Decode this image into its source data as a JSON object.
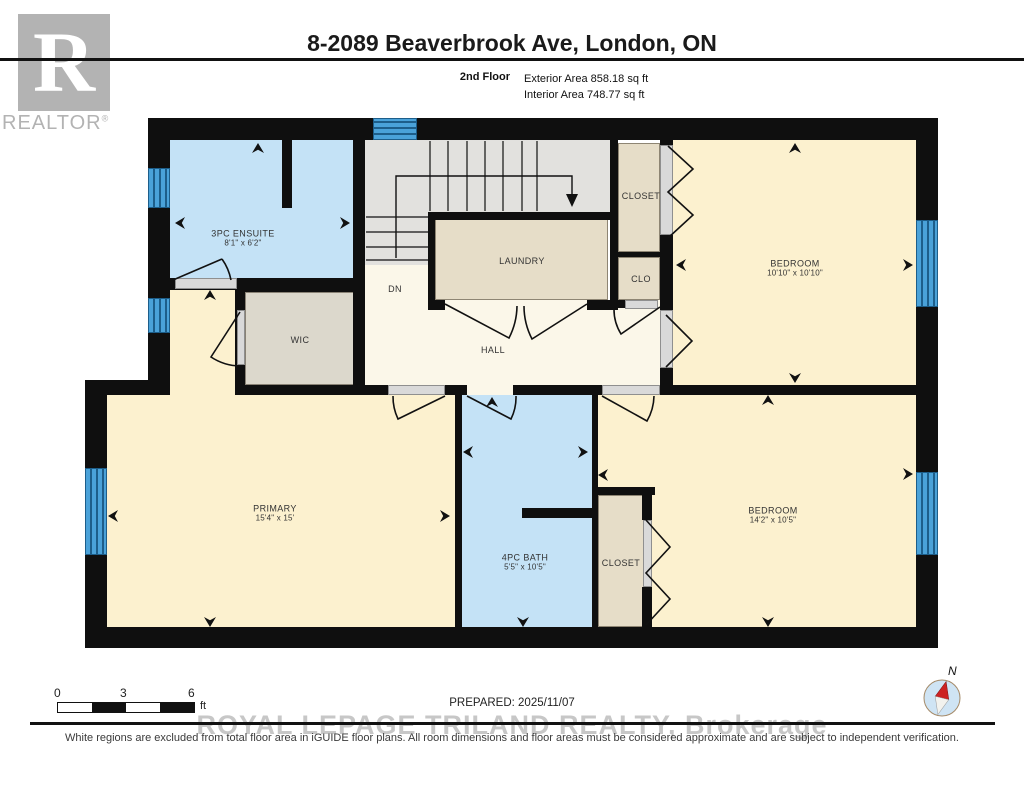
{
  "header": {
    "title": "8-2089 Beaverbrook Ave, London, ON",
    "floor_label": "2nd Floor",
    "exterior_area": "Exterior Area 858.18 sq ft",
    "interior_area": "Interior Area 748.77 sq ft",
    "logo_letter": "R",
    "logo_text": "REALTOR",
    "logo_reg": "®"
  },
  "footer": {
    "scale_ticks": [
      "0",
      "3",
      "6"
    ],
    "scale_unit": "ft",
    "prepared": "PREPARED: 2025/11/07",
    "watermark": "ROYAL LEPAGE TRILAND REALTY, Brokerage",
    "disclaimer": "White regions are excluded from total floor area in iGUIDE floor plans. All room dimensions and floor areas must be considered approximate and are subject to independent verification.",
    "compass_label": "N"
  },
  "colors": {
    "wall": "#0f0f0f",
    "blue_room": "#c4e2f6",
    "cream": "#fcf1cf",
    "hall_cream": "#fbf7e9",
    "tan": "#e6ddc8",
    "wic_tan": "#dcd8cc",
    "stair_gray": "#e2e1de",
    "window_blue": "#4aa2d9",
    "window_line": "#1d5e8a",
    "threshold": "#d9d9d9",
    "threshold_border": "#8f8f8f",
    "line": "#111111"
  },
  "plan": {
    "rooms": [
      {
        "id": "ensuite",
        "label": "3PC ENSUITE",
        "dims": "8'1\" x 6'2\"",
        "x": 90,
        "y": 30,
        "w": 183,
        "h": 140,
        "fill": "blue_room",
        "lx": 163,
        "ly": 128,
        "outline": false
      },
      {
        "id": "stairs-upper",
        "label": "",
        "dims": "",
        "x": 285,
        "y": 30,
        "w": 245,
        "h": 72,
        "fill": "stair_gray",
        "lx": 0,
        "ly": 0,
        "outline": false
      },
      {
        "id": "stairs-lower",
        "label": "",
        "dims": "",
        "x": 285,
        "y": 102,
        "w": 63,
        "h": 53,
        "fill": "stair_gray",
        "lx": 0,
        "ly": 0,
        "outline": false
      },
      {
        "id": "dn-area",
        "label": "DN",
        "dims": "",
        "x": 285,
        "y": 155,
        "w": 63,
        "h": 35,
        "fill": "hall_cream",
        "lx": 315,
        "ly": 179,
        "outline": false
      },
      {
        "id": "laundry",
        "label": "LAUNDRY",
        "dims": "",
        "x": 355,
        "y": 108,
        "w": 173,
        "h": 82,
        "fill": "tan",
        "lx": 442,
        "ly": 151,
        "outline": true
      },
      {
        "id": "closet-top",
        "label": "CLOSET",
        "dims": "",
        "x": 538,
        "y": 33,
        "w": 42,
        "h": 109,
        "fill": "tan",
        "lx": 561,
        "ly": 86,
        "outline": true
      },
      {
        "id": "clo",
        "label": "CLO",
        "dims": "",
        "x": 538,
        "y": 147,
        "w": 42,
        "h": 43,
        "fill": "tan",
        "lx": 561,
        "ly": 169,
        "outline": true
      },
      {
        "id": "bedroom-1",
        "label": "BEDROOM",
        "dims": "10'10\" x 10'10\"",
        "x": 593,
        "y": 30,
        "w": 243,
        "h": 245,
        "fill": "cream",
        "lx": 715,
        "ly": 158,
        "outline": false
      },
      {
        "id": "vestibule",
        "label": "",
        "dims": "",
        "x": 90,
        "y": 180,
        "w": 65,
        "h": 105,
        "fill": "cream",
        "lx": 0,
        "ly": 0,
        "outline": false
      },
      {
        "id": "wic",
        "label": "WIC",
        "dims": "",
        "x": 165,
        "y": 182,
        "w": 110,
        "h": 93,
        "fill": "wic_tan",
        "lx": 220,
        "ly": 230,
        "outline": true
      },
      {
        "id": "hall",
        "label": "HALL",
        "dims": "",
        "x": 285,
        "y": 190,
        "w": 308,
        "h": 95,
        "fill": "hall_cream",
        "lx": 413,
        "ly": 240,
        "outline": false
      },
      {
        "id": "primary",
        "label": "PRIMARY",
        "dims": "15'4\" x 15'",
        "x": 27,
        "y": 285,
        "w": 348,
        "h": 232,
        "fill": "cream",
        "lx": 195,
        "ly": 403,
        "outline": false
      },
      {
        "id": "bath",
        "label": "4PC BATH",
        "dims": "5'5\" x 10'5\"",
        "x": 382,
        "y": 285,
        "w": 130,
        "h": 242,
        "fill": "blue_room",
        "lx": 445,
        "ly": 452,
        "outline": false
      },
      {
        "id": "bedroom-2",
        "label": "BEDROOM",
        "dims": "14'2\" x 10'5\"",
        "x": 518,
        "y": 285,
        "w": 318,
        "h": 232,
        "fill": "cream",
        "lx": 693,
        "ly": 405,
        "outline": false
      },
      {
        "id": "closet-bottom",
        "label": "CLOSET",
        "dims": "",
        "x": 518,
        "y": 385,
        "w": 52,
        "h": 132,
        "fill": "tan",
        "lx": 541,
        "ly": 453,
        "outline": true
      }
    ],
    "walls": [
      [
        68,
        8,
        790,
        22
      ],
      [
        68,
        8,
        22,
        277
      ],
      [
        5,
        270,
        85,
        15
      ],
      [
        5,
        270,
        22,
        268
      ],
      [
        5,
        517,
        853,
        21
      ],
      [
        836,
        8,
        22,
        530
      ],
      [
        273,
        30,
        12,
        145
      ],
      [
        202,
        30,
        10,
        68
      ],
      [
        90,
        168,
        183,
        12
      ],
      [
        155,
        175,
        120,
        7
      ],
      [
        155,
        175,
        10,
        110
      ],
      [
        273,
        175,
        12,
        110
      ],
      [
        348,
        103,
        7,
        87
      ],
      [
        348,
        102,
        182,
        8
      ],
      [
        530,
        30,
        8,
        170
      ],
      [
        538,
        142,
        42,
        5
      ],
      [
        538,
        190,
        12,
        8
      ],
      [
        580,
        30,
        13,
        5
      ],
      [
        580,
        125,
        13,
        75
      ],
      [
        580,
        258,
        13,
        27
      ],
      [
        155,
        275,
        153,
        10
      ],
      [
        365,
        275,
        22,
        10
      ],
      [
        433,
        275,
        89,
        10
      ],
      [
        580,
        275,
        256,
        10
      ],
      [
        375,
        275,
        7,
        252
      ],
      [
        512,
        283,
        6,
        244
      ],
      [
        442,
        398,
        70,
        10
      ],
      [
        518,
        377,
        57,
        8
      ],
      [
        562,
        377,
        10,
        33
      ],
      [
        562,
        477,
        10,
        40
      ],
      [
        348,
        190,
        17,
        10
      ],
      [
        507,
        190,
        23,
        10
      ]
    ],
    "thresholds": [
      [
        95,
        168,
        62,
        11
      ],
      [
        157,
        200,
        8,
        55
      ],
      [
        308,
        275,
        57,
        10
      ],
      [
        522,
        275,
        58,
        10
      ],
      [
        580,
        35,
        13,
        90
      ],
      [
        580,
        200,
        13,
        58
      ],
      [
        563,
        410,
        9,
        67
      ],
      [
        545,
        190,
        33,
        9
      ]
    ],
    "windows": [
      [
        293,
        8,
        44,
        22
      ],
      [
        68,
        58,
        22,
        40
      ],
      [
        68,
        188,
        22,
        35
      ],
      [
        5,
        358,
        22,
        87
      ],
      [
        836,
        110,
        22,
        87
      ],
      [
        836,
        362,
        22,
        83
      ]
    ],
    "stairs": {
      "vlines": [
        350,
        368,
        387,
        405,
        423,
        442,
        457
      ],
      "v_y1": 31,
      "v_y2": 101,
      "hlines": [
        107,
        122,
        137,
        150
      ],
      "h_x1": 286,
      "h_x2": 348,
      "arrow_path": "M 316 148 L 316 66 L 492 66 L 492 86",
      "arrow_head": "486,84 498,84 492,97"
    },
    "doors": [
      "M 142 149 A 54 54 0 0 1 151 170 M 93 170 L 142 149",
      "M 160 202 L 131 247 A 54 54 0 0 0 160 256",
      "M 365 194 L 429 228 A 72 72 0 0 0 437 196",
      "M 507 194 L 452 229 A 72 72 0 0 1 444 196",
      "M 365 286 L 318 309 A 52 52 0 0 1 313 286",
      "M 387 286 L 431 309 A 49 49 0 0 0 436 286",
      "M 522 286 L 567 311 A 52 52 0 0 0 574 286",
      "M 580 197 L 541 224 A 47 47 0 0 1 534 198"
    ],
    "bifolds": [
      "M 588 36 L 613 59 L 588 82 L 613 105 L 588 128",
      "M 586 205 L 612 231 L 586 257",
      "M 566 410 L 590 437 L 566 463 L 590 489 L 566 515"
    ],
    "markers": [
      [
        178,
        38,
        "up"
      ],
      [
        100,
        113,
        "left"
      ],
      [
        265,
        113,
        "right"
      ],
      [
        130,
        185,
        "up"
      ],
      [
        715,
        38,
        "up"
      ],
      [
        715,
        268,
        "down"
      ],
      [
        601,
        155,
        "left"
      ],
      [
        828,
        155,
        "right"
      ],
      [
        33,
        406,
        "left"
      ],
      [
        365,
        406,
        "right"
      ],
      [
        130,
        512,
        "down"
      ],
      [
        388,
        342,
        "left"
      ],
      [
        503,
        342,
        "right"
      ],
      [
        443,
        512,
        "down"
      ],
      [
        412,
        292,
        "up"
      ],
      [
        688,
        290,
        "up"
      ],
      [
        688,
        512,
        "down"
      ],
      [
        828,
        364,
        "right"
      ],
      [
        523,
        365,
        "left"
      ]
    ]
  }
}
